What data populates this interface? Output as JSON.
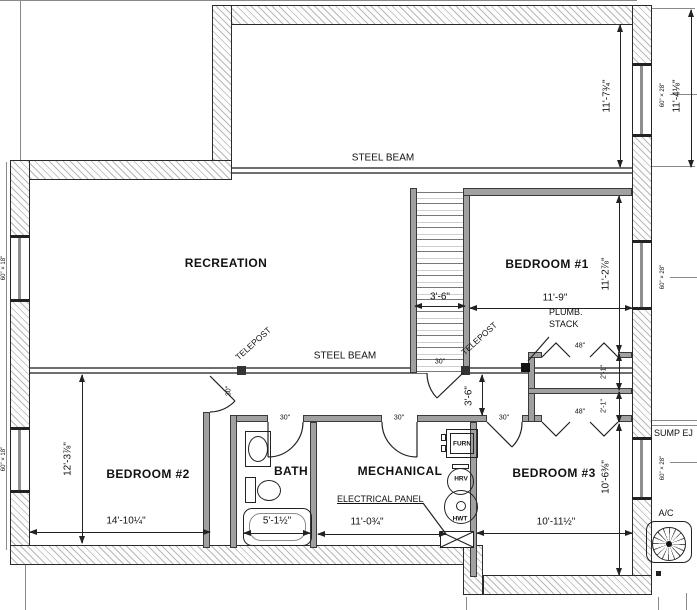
{
  "rooms": {
    "recreation": "RECREATION",
    "bedroom1": "BEDROOM #1",
    "bedroom2": "BEDROOM #2",
    "bedroom3": "BEDROOM #3",
    "bath": "BATH",
    "mechanical": "MECHANICAL"
  },
  "structure": {
    "steel_beam": "STEEL BEAM",
    "telepost": "TELEPOST",
    "plumb_line1": "PLUMB.",
    "plumb_line2": "STACK"
  },
  "equipment": {
    "furnace": "FURN",
    "hrv": "HRV",
    "hwt": "HWT",
    "electrical_panel": "ELECTRICAL PANEL",
    "sump": "SUMP EJ",
    "ac": "A/C"
  },
  "dims": {
    "top_right_inner": "11'-7¾\"",
    "top_right_outer": "11'-4⅛\"",
    "bed1_w": "11'-9\"",
    "bed1_h": "11'-2⅞\"",
    "stair_w": "3'-6\"",
    "hall_w": "3'-6\"",
    "bed2_h": "12'-3⅞\"",
    "bed2_w": "14'-10¼\"",
    "bath_w": "5'-1½\"",
    "mech_w": "11'-0¾\"",
    "bed3_w": "10'-11½\"",
    "bed3_h": "10'-6⅜\"",
    "closet_d": "2'-1\""
  },
  "openings": {
    "door_w": "30\"",
    "closet_w": "48\"",
    "win_60x28": "60\" × 28\"",
    "win_60x18": "60\" × 18\""
  },
  "colors": {
    "wall_hatch": "#b8b8b8",
    "interior_wall": "#a0a0a0",
    "beam": "#6e6e6e",
    "line": "#222222"
  }
}
